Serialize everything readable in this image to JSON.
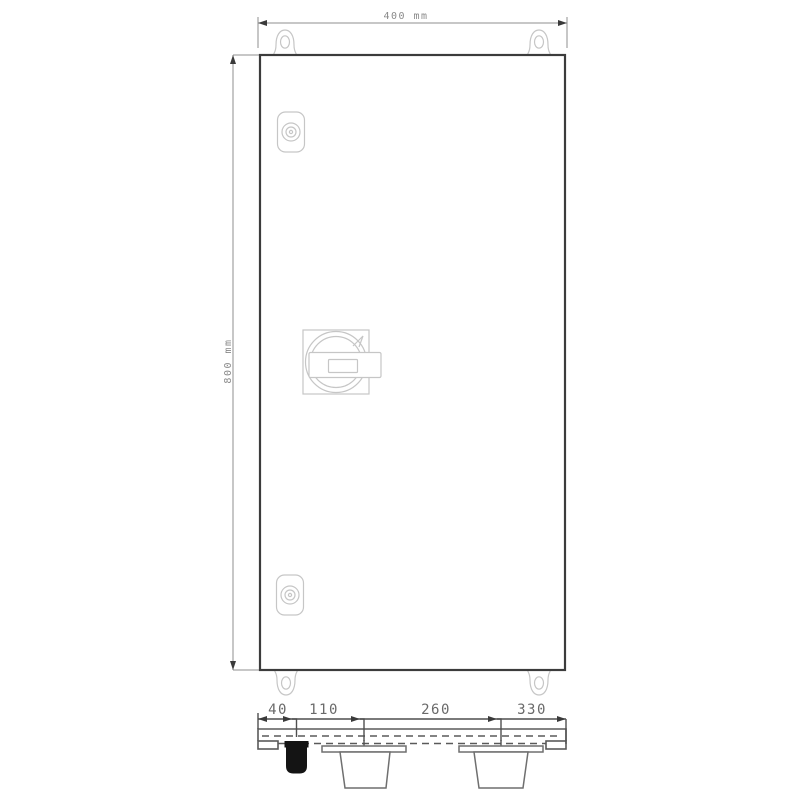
{
  "drawing": {
    "front_view": {
      "width_dimension": {
        "text": "400 mm",
        "value": 400,
        "unit": "mm"
      },
      "height_dimension": {
        "text": "800 mm",
        "value": 800,
        "unit": "mm"
      },
      "components": [
        "mounting-lug-top-left",
        "mounting-lug-top-right",
        "mounting-lug-bottom-left",
        "mounting-lug-bottom-right",
        "door-lock-top",
        "door-lock-bottom",
        "rotary-door-handle"
      ]
    },
    "bottom_view": {
      "dimensions": [
        {
          "text": "40",
          "value": 40
        },
        {
          "text": "110",
          "value": 110
        },
        {
          "text": "260",
          "value": 260
        },
        {
          "text": "330",
          "value": 330
        }
      ],
      "components": [
        "small-cable-gland-filled",
        "cable-gland-left",
        "cable-gland-right"
      ]
    },
    "colors": {
      "enclosure_outline": "#3c3c3c",
      "hardware_detail": "#c6c6c6",
      "dimension_line_front": "#8f8f8f",
      "dimension_line_bottom": "#4f4f4f",
      "dimension_text_front": "#8a8a8a",
      "dimension_text_bottom": "#6a6a6a",
      "gland_fill": "#141414",
      "background": "#ffffff"
    }
  }
}
